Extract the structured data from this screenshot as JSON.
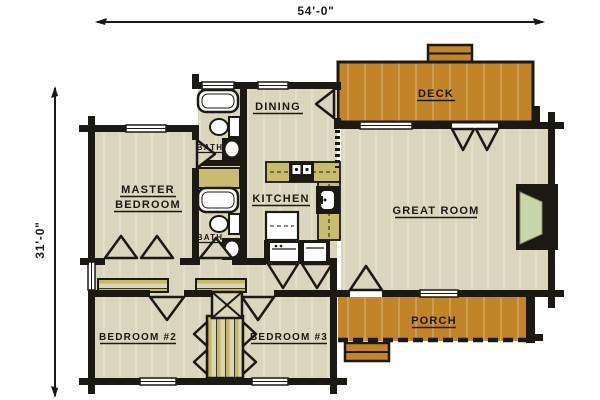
{
  "plan": {
    "title": "Log home floor plan",
    "dimensions": {
      "width": "54'-0\"",
      "height": "31'-0\""
    },
    "rooms": {
      "master_bedroom_line1": "MASTER",
      "master_bedroom_line2": "BEDROOM",
      "dining": "DINING",
      "kitchen": "KITCHEN",
      "great_room": "GREAT ROOM",
      "deck": "DECK",
      "porch": "PORCH",
      "bedroom2": "BEDROOM #2",
      "bedroom3": "BEDROOM #3",
      "bath_upper": "BATH",
      "bath_lower": "BATH"
    },
    "fixtures": [
      "bathtub-upper",
      "toilet-upper",
      "vanity-sink-upper",
      "linen-closet",
      "bathtub-lower",
      "toilet-lower",
      "vanity-sink-lower",
      "range",
      "kitchen-sink",
      "refrigerator",
      "washer",
      "dryer",
      "fireplace",
      "master-closet",
      "bedroom-closets",
      "chimney-chase",
      "deck-steps",
      "porch-steps"
    ],
    "colors": {
      "wall": "#1c1813",
      "floor": "#dbd5bd",
      "deck": "#c18428",
      "cabinet": "#c9bc6e",
      "fireplace_hearth": "#c9d6aa",
      "background": "#ffffff"
    }
  }
}
